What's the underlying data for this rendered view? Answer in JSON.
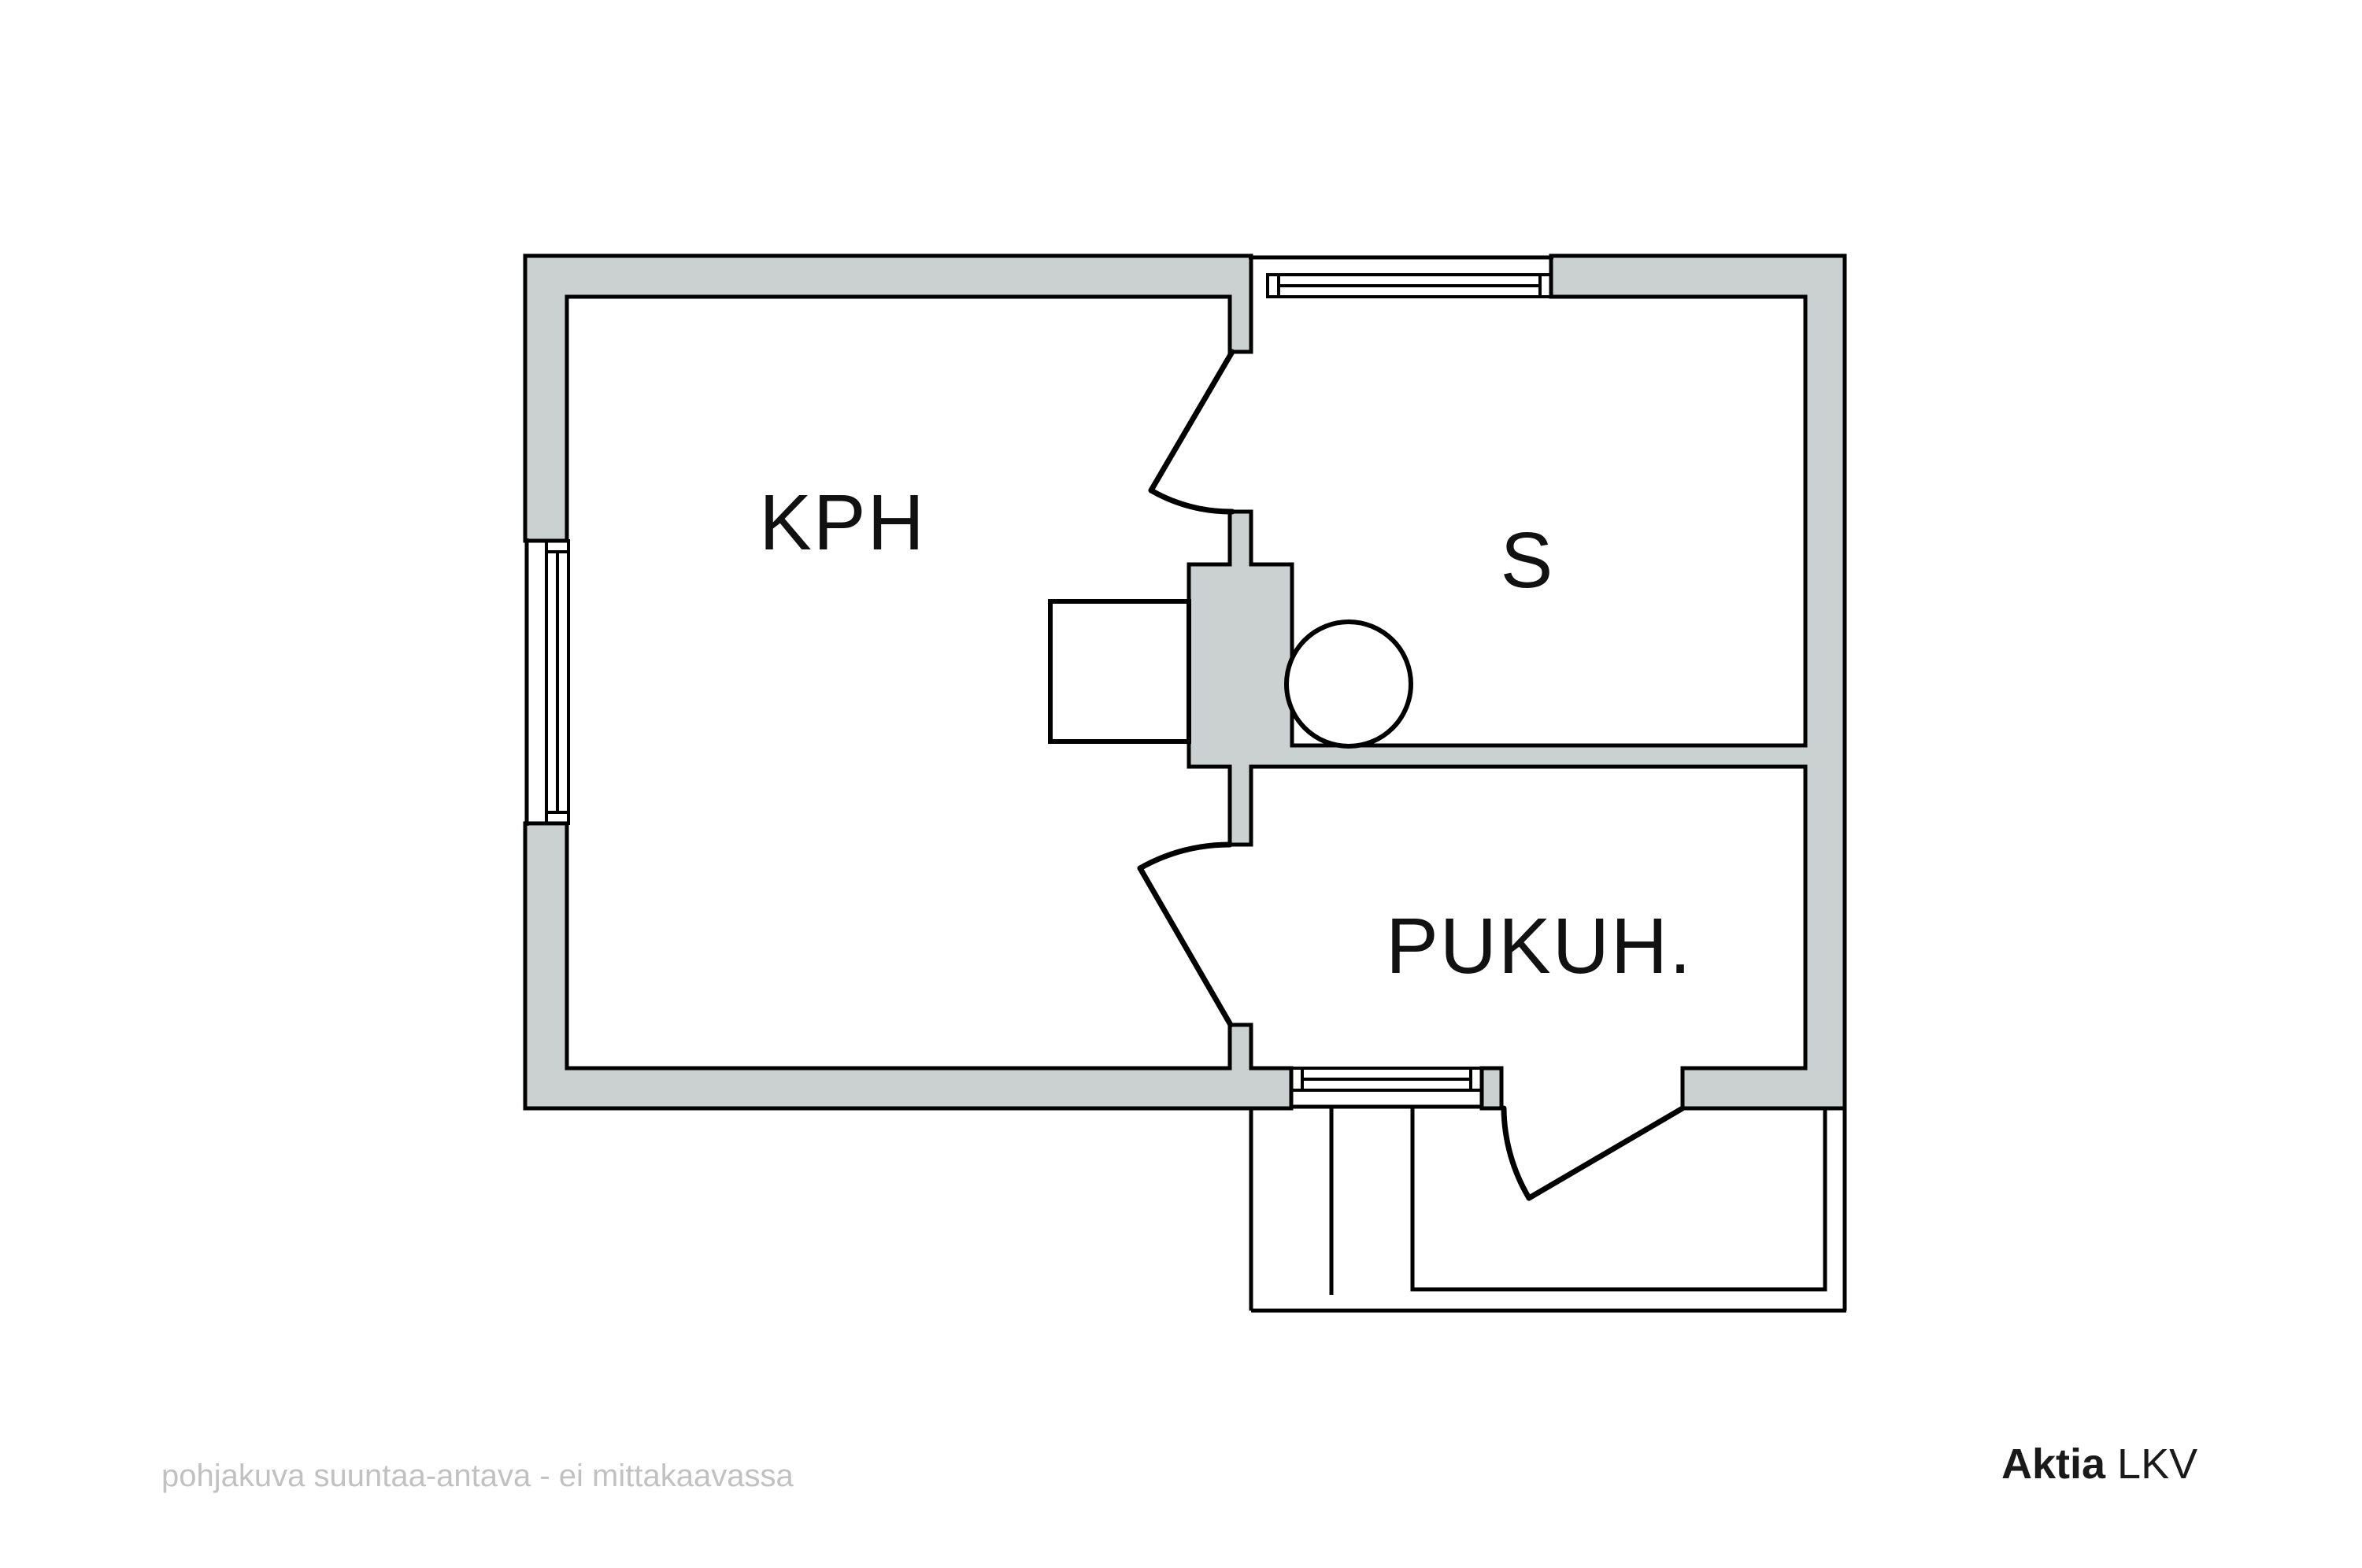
{
  "title": "floor plan",
  "rooms": {
    "kph": {
      "label": "KPH"
    },
    "sauna": {
      "label": "S"
    },
    "pukuh": {
      "label": "PUKUH."
    }
  },
  "footer": {
    "disclaimer": "pohjakuva suuntaa-antava - ei mittakaavassa"
  },
  "logo": {
    "brand": "Aktia",
    "suffix": " LKV"
  },
  "colors": {
    "wall_fill": "#cad1d0",
    "line": "#000000",
    "fixture_fill": "#ffffff",
    "disclaimer_text": "#c1c1c1",
    "logo_text": "#1a1a1a"
  }
}
